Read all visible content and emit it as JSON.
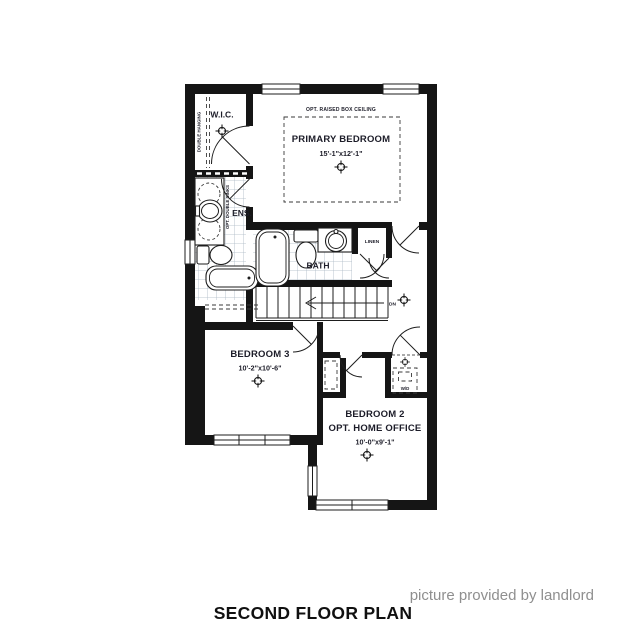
{
  "plan": {
    "title": "SECOND FLOOR PLAN",
    "credit": "picture provided by landlord",
    "rooms": {
      "wic": {
        "label": "W.I.C."
      },
      "ens": {
        "label": "ENS."
      },
      "primary": {
        "label": "PRIMARY BEDROOM",
        "dims": "15'-1\"x12'-1\"",
        "ceiling_note": "OPT. RAISED BOX CEILING"
      },
      "bath": {
        "label": "BATH"
      },
      "linen": {
        "label": "LINEN"
      },
      "bedroom3": {
        "label": "BEDROOM 3",
        "dims": "10'-2\"x10'-6\""
      },
      "bedroom2": {
        "label": "BEDROOM 2",
        "sublabel": "OPT. HOME OFFICE",
        "dims": "10'-0\"x9'-1\""
      },
      "laundry": {
        "label": "W/D"
      }
    },
    "annotations": {
      "double_hanging": "DOUBLE HANGING",
      "opt_double_sinks": "OPT. DOUBLE SINKS",
      "stairs_down": "DN"
    },
    "colors": {
      "wall": "#151515",
      "tile_line": "#aab7c3",
      "text": "#1c1c28",
      "credit_gray": "#8f8f8f"
    }
  }
}
